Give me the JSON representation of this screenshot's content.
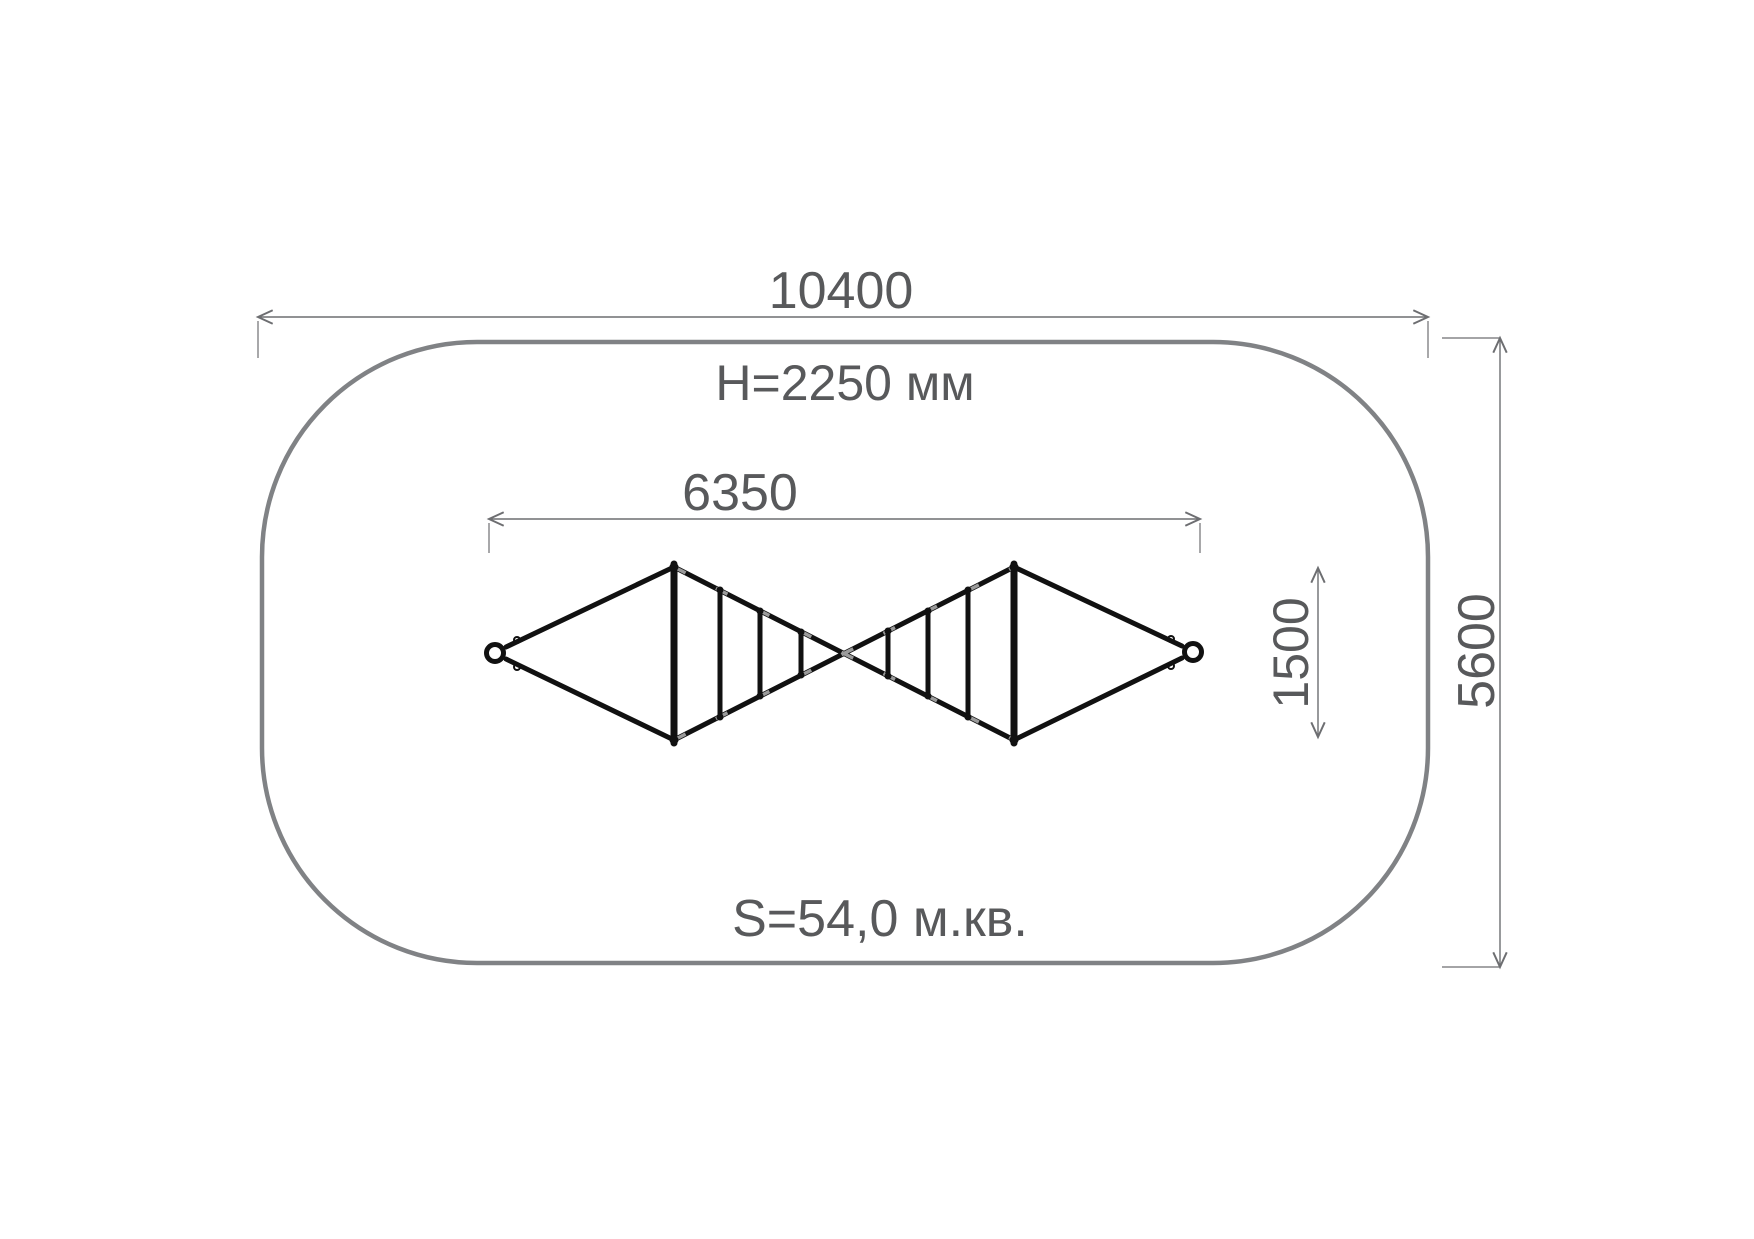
{
  "drawing": {
    "kind": "playground rope climber plan view",
    "labels": {
      "site_width": "10400",
      "site_height": "5600",
      "equipment_height": "H=2250 мм",
      "equipment_length": "6350",
      "equipment_half_width": "1500",
      "area": "S=54,0 м.кв."
    },
    "colors": {
      "site_outline": "#808285",
      "dimension_lines": "#6d6e71",
      "dimension_text": "#58595b",
      "structure": "#111111",
      "rope_texture": "#9b9b9b",
      "background": "#ffffff"
    }
  }
}
